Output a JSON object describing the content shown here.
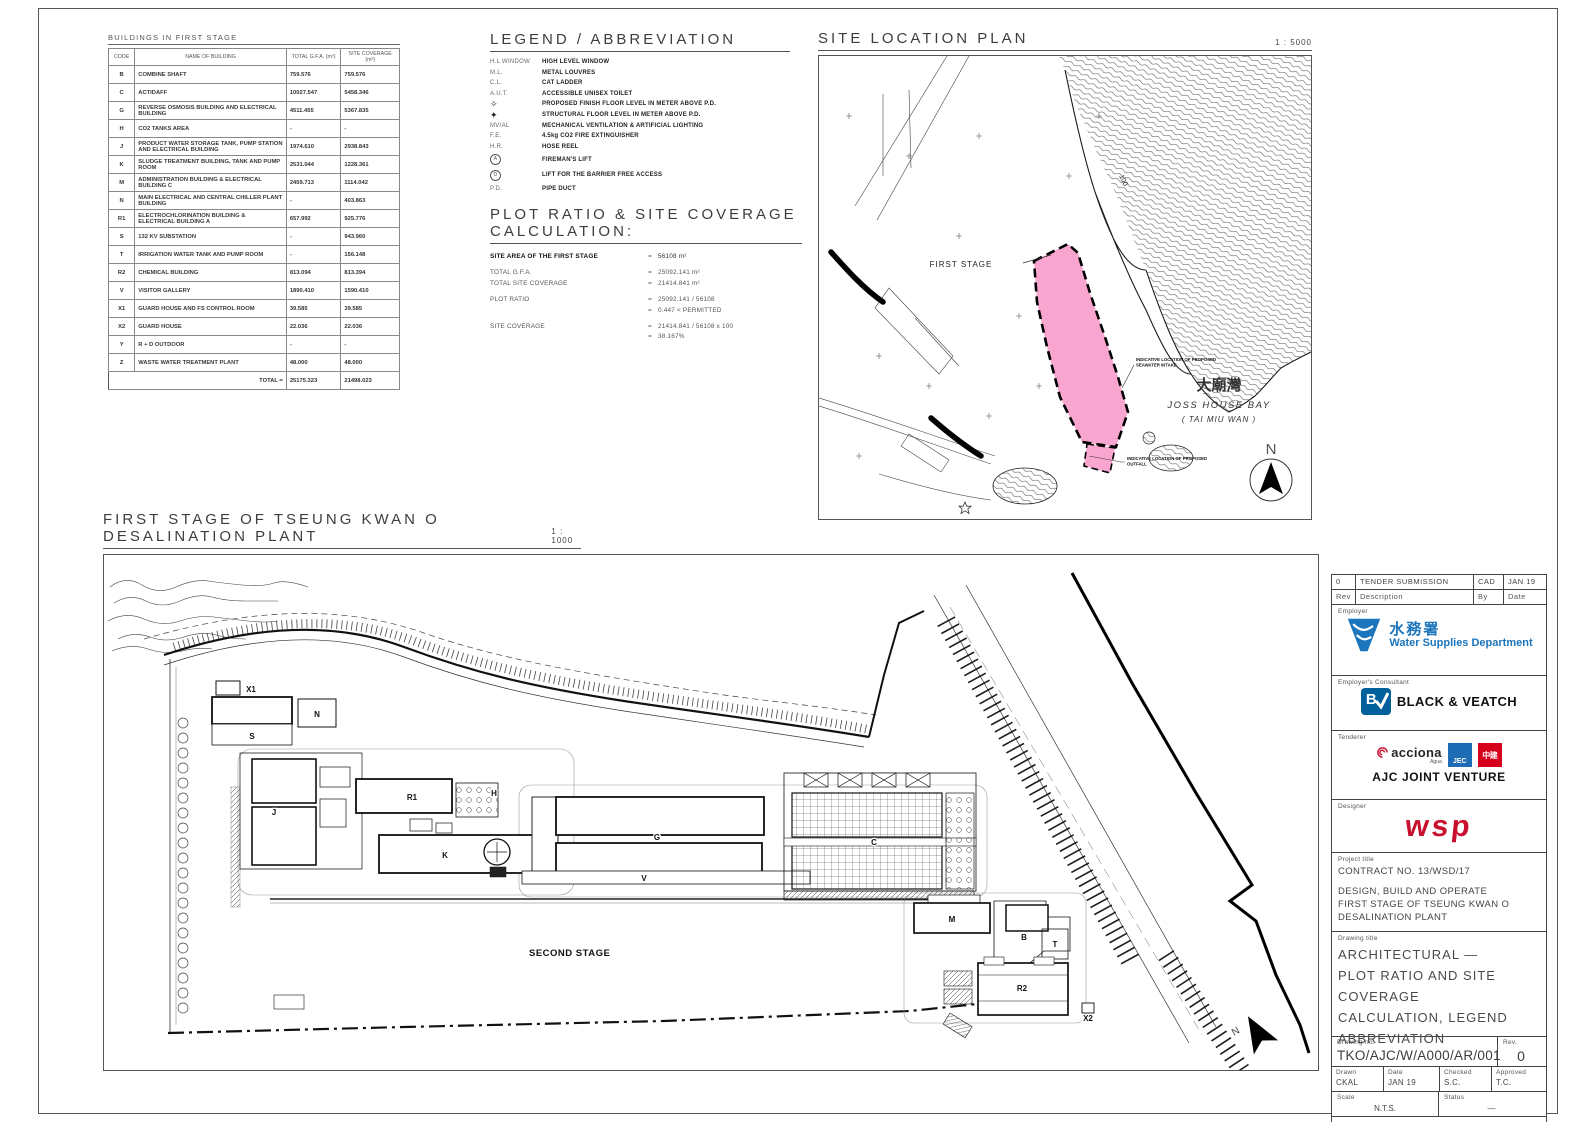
{
  "colors": {
    "pink": "#f8a6d0",
    "wsd_blue": "#1b75bc",
    "bv_blue": "#00609c",
    "jec_blue": "#1e6cb3",
    "cscec_red": "#d6001c",
    "wsp_red": "#c8102e"
  },
  "buildings_table": {
    "title": "BUILDINGS IN FIRST STAGE",
    "headers": [
      "CODE",
      "NAME OF BUILDING",
      "TOTAL G.F.A. (m²)",
      "SITE COVERAGE (m²)"
    ],
    "rows": [
      [
        "B",
        "COMBINE SHAFT",
        "759.576",
        "759.576"
      ],
      [
        "C",
        "ACTIDAFF",
        "10027.547",
        "5458.346"
      ],
      [
        "G",
        "REVERSE OSMOSIS BUILDING AND ELECTRICAL BUILDING",
        "4511.455",
        "5367.835"
      ],
      [
        "H",
        "CO2 TANKS AREA",
        "-",
        "-"
      ],
      [
        "J",
        "PRODUCT WATER STORAGE TANK, PUMP STATION AND ELECTRICAL BUILDING",
        "1974.610",
        "2938.843"
      ],
      [
        "K",
        "SLUDGE TREATMENT BUILDING, TANK AND PUMP ROOM",
        "2531.044",
        "1228.361"
      ],
      [
        "M",
        "ADMINISTRATION BUILDING & ELECTRICAL BUILDING C",
        "2459.713",
        "1114.042"
      ],
      [
        "N",
        "MAIN ELECTRICAL AND CENTRAL CHILLER PLANT BUILDING",
        "-",
        "403.863"
      ],
      [
        "R1",
        "ELECTROCHLORINATION BUILDING & ELECTRICAL BUILDING A",
        "657.992",
        "925.776"
      ],
      [
        "S",
        "132 KV SUBSTATION",
        "-",
        "943.960"
      ],
      [
        "T",
        "IRRIGATION WATER TANK AND PUMP ROOM",
        "-",
        "156.148"
      ],
      [
        "R2",
        "CHEMICAL BUILDING",
        "813.094",
        "813.394"
      ],
      [
        "V",
        "VISITOR GALLERY",
        "1890.410",
        "1590.410"
      ],
      [
        "X1",
        "GUARD HOUSE AND FS CONTROL ROOM",
        "39.585",
        "39.585"
      ],
      [
        "X2",
        "GUARD HOUSE",
        "22.036",
        "22.036"
      ],
      [
        "Y",
        "R + D OUTDOOR",
        "-",
        "-"
      ],
      [
        "Z",
        "WASTE WATER TREATMENT PLANT",
        "48.000",
        "48.000"
      ]
    ],
    "total_label": "TOTAL =",
    "total_gfa": "25175.323",
    "total_coverage": "21498.023"
  },
  "legend": {
    "title": "LEGEND / ABBREVIATION",
    "items": [
      {
        "sym": "H.L WINDOW",
        "desc": "HIGH LEVEL WINDOW"
      },
      {
        "sym": "M.L.",
        "desc": "METAL LOUVRES"
      },
      {
        "sym": "C.L.",
        "desc": "CAT LADDER"
      },
      {
        "sym": "A.U.T.",
        "desc": "ACCESSIBLE UNISEX TOILET"
      },
      {
        "sym": "✧",
        "kind": "mark",
        "desc": "PROPOSED FINISH FLOOR LEVEL IN METER ABOVE P.D."
      },
      {
        "sym": "✦",
        "kind": "mark",
        "desc": "STRUCTURAL FLOOR LEVEL IN METER ABOVE P.D."
      },
      {
        "sym": "MV/AL",
        "desc": "MECHANICAL VENTILATION & ARTIFICIAL LIGHTING"
      },
      {
        "sym": "F.E.",
        "desc": "4.5kg CO2 FIRE EXTINGUISHER"
      },
      {
        "sym": "H.R.",
        "desc": "HOSE REEL"
      },
      {
        "sym": "A",
        "kind": "circle",
        "desc": "FIREMAN'S LIFT"
      },
      {
        "sym": "D",
        "kind": "circle",
        "desc": "LIFT FOR THE BARRIER FREE ACCESS"
      },
      {
        "sym": "P.D.",
        "desc": "PIPE DUCT"
      }
    ]
  },
  "plot_ratio": {
    "title": "PLOT RATIO & SITE COVERAGE CALCULATION:",
    "lines": [
      {
        "label": "SITE AREA OF THE FIRST STAGE",
        "value": "56108 m²",
        "bold": true
      },
      {
        "spacer": true
      },
      {
        "label": "TOTAL G.F.A.",
        "value": "25092.141 m²"
      },
      {
        "label": "TOTAL SITE COVERAGE",
        "value": "21414.841 m²"
      },
      {
        "spacer": true
      },
      {
        "label": "PLOT RATIO",
        "value": "25092.141 / 56108"
      },
      {
        "label": "",
        "value": "0.447   <   PERMITTED"
      },
      {
        "spacer": true
      },
      {
        "label": "SITE COVERAGE",
        "value": "21414.841 / 56108 x 100"
      },
      {
        "label": "",
        "value": "38.167%"
      }
    ]
  },
  "site_plan": {
    "title": "SITE LOCATION PLAN",
    "scale": "1 : 5000",
    "first_stage_label": "FIRST STAGE",
    "contour_label": "100",
    "bay_name_cn": "大廟灣",
    "bay_name_en": "JOSS HOUSE BAY",
    "bay_name_alt": "( TAI MIU WAN )",
    "north_label": "N",
    "note_intake_lines": [
      "INDICATIVE LOCATION OF PROPOSED",
      "SEAWATER INTAKE"
    ],
    "note_outfall_lines": [
      "INDICATIVE LOCATION OF PROPOSED",
      "OUTFALL"
    ]
  },
  "main_plan": {
    "title": "FIRST STAGE OF TSEUNG KWAN O DESALINATION PLANT",
    "scale": "1 : 1000",
    "second_stage_label": "SECOND STAGE",
    "north_label": "N",
    "building_labels": {
      "x1": "X1",
      "s": "S",
      "n": "N",
      "j": "J",
      "r1": "R1",
      "h": "H",
      "k": "K",
      "g": "G",
      "v": "V",
      "c": "C",
      "m": "M",
      "b": "B",
      "t": "T",
      "r2": "R2",
      "x2": "X2"
    }
  },
  "title_block": {
    "revision": {
      "rev": "0",
      "description": "TENDER SUBMISSION",
      "by": "CAD",
      "date": "JAN 19"
    },
    "revision_headers": {
      "rev": "Rev",
      "description": "Description",
      "by": "By",
      "date": "Date"
    },
    "employer": {
      "label": "Employer",
      "name_cn": "水務署",
      "name_en": "Water Supplies Department"
    },
    "consultant": {
      "label": "Employer's Consultant",
      "logo_text": "B",
      "name": "BLACK & VEATCH"
    },
    "tenderer": {
      "label": "Tenderer",
      "acciona": "acciona",
      "acciona_sub": "Agua",
      "jec": "JEC",
      "cscec": "中建",
      "name": "AJC JOINT VENTURE"
    },
    "designer": {
      "label": "Designer",
      "name": "wsp"
    },
    "project": {
      "label": "Project title",
      "lines": [
        "CONTRACT NO. 13/WSD/17",
        "",
        "DESIGN, BUILD AND OPERATE",
        "FIRST STAGE OF TSEUNG KWAN O",
        "DESALINATION PLANT"
      ]
    },
    "drawing": {
      "label": "Drawing title",
      "lines": [
        "ARCHITECTURAL —",
        "PLOT RATIO AND SITE COVERAGE",
        "CALCULATION, LEGEND",
        "ABBREVIATION"
      ]
    },
    "drawing_no": {
      "label": "Drawing no.",
      "value": "TKO/AJC/W/A000/AR/001",
      "rev_label": "Rev.",
      "rev_value": "0"
    },
    "signoff": {
      "drawn_label": "Drawn",
      "drawn": "CKAL",
      "date_label": "Date",
      "date": "JAN 19",
      "checked_label": "Checked",
      "checked": "S.C.",
      "approved_label": "Approved",
      "approved": "T.C."
    },
    "scale": {
      "label": "Scale",
      "value": "N.T.S."
    },
    "status": {
      "label": "Status",
      "value": "—"
    },
    "copyright": "©COPYRIGHT RESERVED"
  }
}
